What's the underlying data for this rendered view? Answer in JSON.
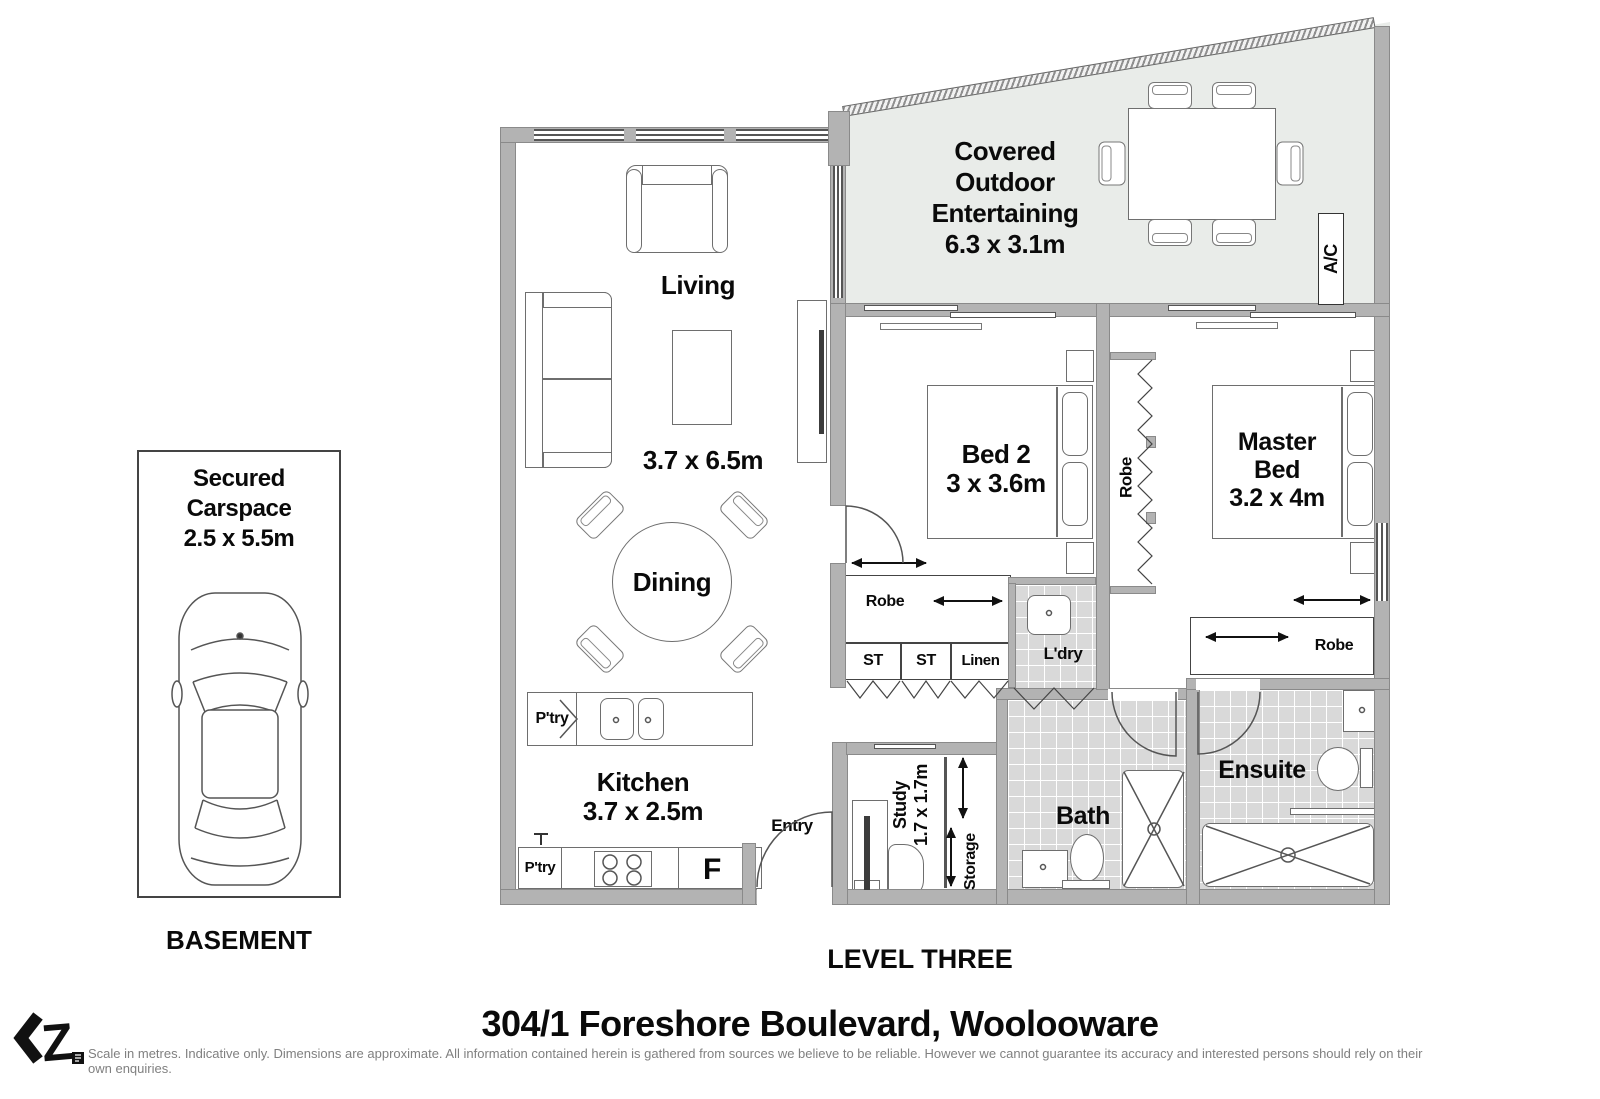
{
  "page": {
    "address": "304/1 Foreshore Boulevard, Woolooware",
    "disclaimer": "Scale in metres. Indicative only. Dimensions are approximate. All information contained herein is gathered from sources we believe to be reliable. However we cannot guarantee its accuracy and interested persons should rely on their own enquiries.",
    "level_label": "LEVEL THREE",
    "basement_label": "BASEMENT",
    "logo_text": "Z"
  },
  "colors": {
    "wall": "#b3b3b3",
    "outdoor_fill": "#e9ece9",
    "tile_floor": "#d9d9d9",
    "line": "#555555",
    "text": "#0a0a0a"
  },
  "carspace": {
    "line1": "Secured",
    "line2": "Carspace",
    "dims": "2.5 x 5.5m"
  },
  "rooms": {
    "living": {
      "name": "Living",
      "dims": "3.7 x 6.5m"
    },
    "dining": {
      "name": "Dining"
    },
    "kitchen": {
      "name": "Kitchen",
      "dims": "3.7 x 2.5m"
    },
    "outdoor": {
      "line1": "Covered",
      "line2": "Outdoor",
      "line3": "Entertaining",
      "dims": "6.3 x 3.1m"
    },
    "bed2": {
      "name": "Bed 2",
      "dims": "3 x 3.6m"
    },
    "master": {
      "line1": "Master",
      "line2": "Bed",
      "dims": "3.2 x 4m"
    },
    "bath": {
      "name": "Bath"
    },
    "ensuite": {
      "name": "Ensuite"
    },
    "study": {
      "name": "Study",
      "dims": "1.7 x 1.7m"
    },
    "entry": {
      "name": "Entry"
    },
    "ldry": {
      "name": "L'dry"
    },
    "storage": {
      "name": "Storage"
    },
    "linen": {
      "name": "Linen"
    },
    "st1": {
      "name": "ST"
    },
    "st2": {
      "name": "ST"
    },
    "robe_corridor": {
      "name": "Robe"
    },
    "robe_bed2": {
      "name": "Robe"
    },
    "robe_master": {
      "name": "Robe"
    },
    "ac": {
      "name": "A/C"
    },
    "pantry_top": {
      "name": "P'try"
    },
    "pantry_bottom": {
      "name": "P'try"
    },
    "fridge": {
      "name": "F"
    }
  }
}
